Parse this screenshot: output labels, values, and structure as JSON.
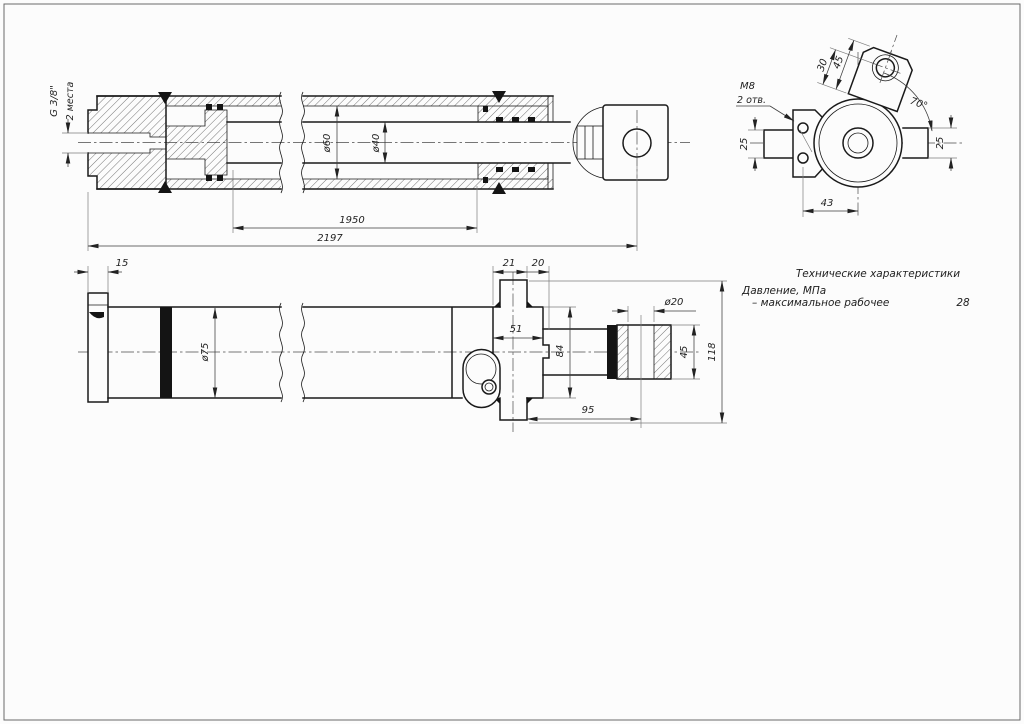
{
  "style": {
    "paper_color": "#fcfcfc",
    "line_color": "#1a1a1a",
    "dim_line_color": "#3c3c3c"
  },
  "dims": {
    "port_thread": "G 3/8\"",
    "port_places": "2 места",
    "bore_dia": "ø60",
    "rod_dia": "ø40",
    "stroke_length": "1950",
    "total_length": "2197",
    "cap_width": "15",
    "trunnion_21": "21",
    "trunnion_20": "20",
    "outer_dia": "ø75",
    "head_width": "51",
    "head_height": "84",
    "eye_hole_dia": "ø20",
    "eye_height": "45",
    "trunnion_span": "118",
    "eye_offset": "95",
    "holes_thread": "M8",
    "holes_count": "2 отв.",
    "boss_length": "45",
    "boss_port_offset": "30",
    "boss_angle": "70°",
    "flat_left": "25",
    "flat_right": "25",
    "holes_offset": "43"
  },
  "specs": {
    "title": "Технические характеристики",
    "rows": [
      {
        "label": "Давление, МПа",
        "sub_label": "– максимальное рабочее",
        "value": "28"
      }
    ]
  }
}
